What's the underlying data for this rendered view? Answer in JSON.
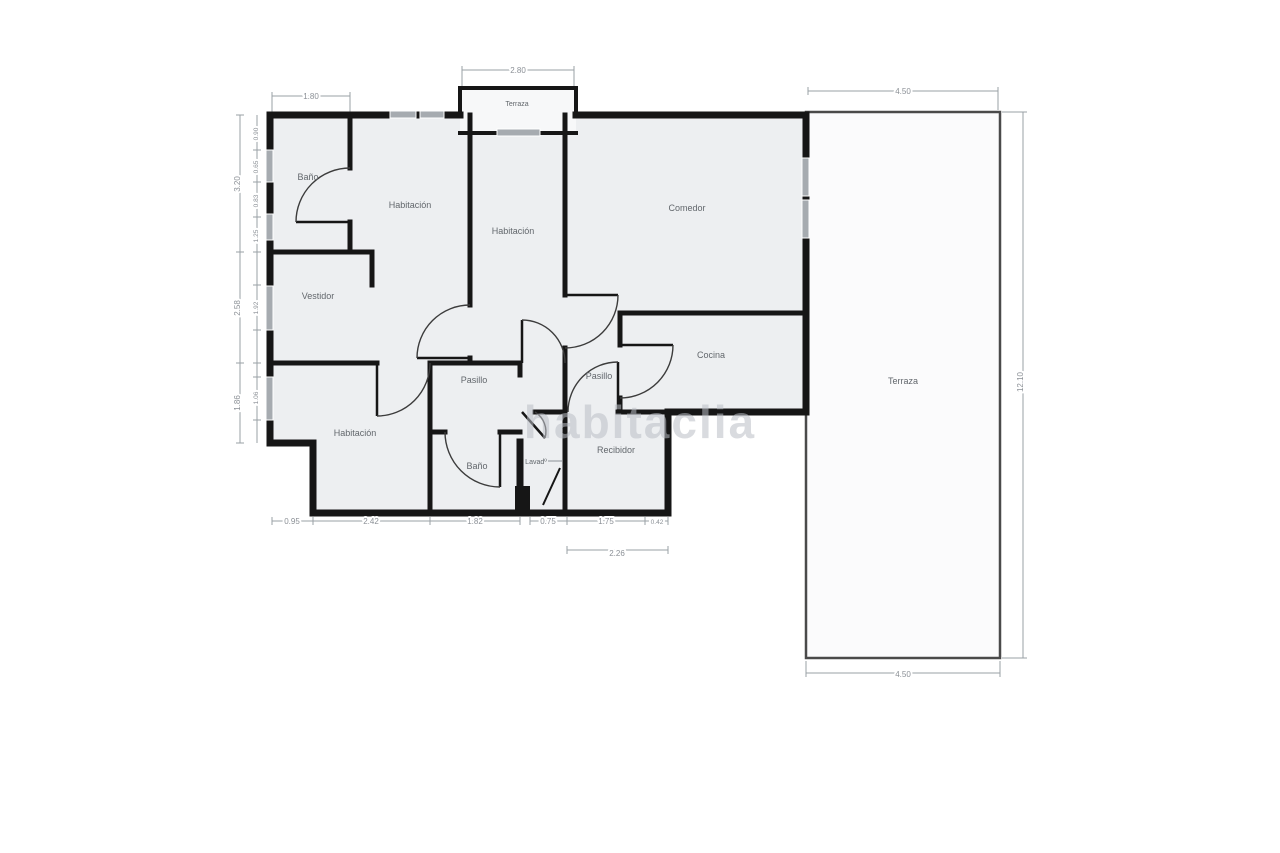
{
  "watermark": "habitaclia",
  "colors": {
    "wall": "#161616",
    "room_fill": "#edeff1",
    "terrace_fill": "#fbfbfc",
    "window": "#a6abb0",
    "dimension": "#9aa0a5",
    "label": "#62676c"
  },
  "floorplan": {
    "rooms": [
      {
        "name": "Baño",
        "x": 308,
        "y": 180
      },
      {
        "name": "Habitación",
        "x": 410,
        "y": 208
      },
      {
        "name": "Habitación",
        "x": 513,
        "y": 234
      },
      {
        "name": "Comedor",
        "x": 687,
        "y": 211
      },
      {
        "name": "Terraza",
        "x": 517,
        "y": 106,
        "small": true
      },
      {
        "name": "Vestidor",
        "x": 318,
        "y": 299
      },
      {
        "name": "Cocina",
        "x": 711,
        "y": 358
      },
      {
        "name": "Pasillo",
        "x": 474,
        "y": 383
      },
      {
        "name": "Pasillo",
        "x": 599,
        "y": 379
      },
      {
        "name": "Habitación",
        "x": 355,
        "y": 436
      },
      {
        "name": "Baño",
        "x": 477,
        "y": 469
      },
      {
        "name": "Lavadº",
        "x": 536,
        "y": 464,
        "small": true
      },
      {
        "name": "Recibidor",
        "x": 616,
        "y": 453
      },
      {
        "name": "Terraza",
        "x": 903,
        "y": 384
      }
    ],
    "dimensions": [
      {
        "text": "1.80",
        "x": 311,
        "y": 99
      },
      {
        "text": "2.80",
        "x": 518,
        "y": 73
      },
      {
        "text": "4.50",
        "x": 903,
        "y": 94
      },
      {
        "text": "12.10",
        "x": 1023,
        "y": 382,
        "rot": -90
      },
      {
        "text": "0.95",
        "x": 292,
        "y": 524
      },
      {
        "text": "2.42",
        "x": 371,
        "y": 524
      },
      {
        "text": "1.82",
        "x": 475,
        "y": 524
      },
      {
        "text": "0.75",
        "x": 548,
        "y": 524
      },
      {
        "text": "1.75",
        "x": 606,
        "y": 524
      },
      {
        "text": "0.42",
        "x": 657,
        "y": 524,
        "small": true
      },
      {
        "text": "2.26",
        "x": 617,
        "y": 556
      },
      {
        "text": "4.50",
        "x": 903,
        "y": 677
      },
      {
        "text": "3.20",
        "x": 240,
        "y": 184,
        "rot": -90
      },
      {
        "text": "2.58",
        "x": 240,
        "y": 308,
        "rot": -90
      },
      {
        "text": "1.86",
        "x": 240,
        "y": 403,
        "rot": -90
      },
      {
        "text": "0.90",
        "x": 258,
        "y": 134,
        "rot": -90,
        "small": true
      },
      {
        "text": "0.65",
        "x": 258,
        "y": 167,
        "rot": -90,
        "small": true
      },
      {
        "text": "0.83",
        "x": 258,
        "y": 201,
        "rot": -90,
        "small": true
      },
      {
        "text": "1.25",
        "x": 258,
        "y": 236,
        "rot": -90,
        "small": true
      },
      {
        "text": "1.92",
        "x": 258,
        "y": 308,
        "rot": -90,
        "small": true
      },
      {
        "text": "1.06",
        "x": 258,
        "y": 398,
        "rot": -90,
        "small": true
      }
    ]
  }
}
